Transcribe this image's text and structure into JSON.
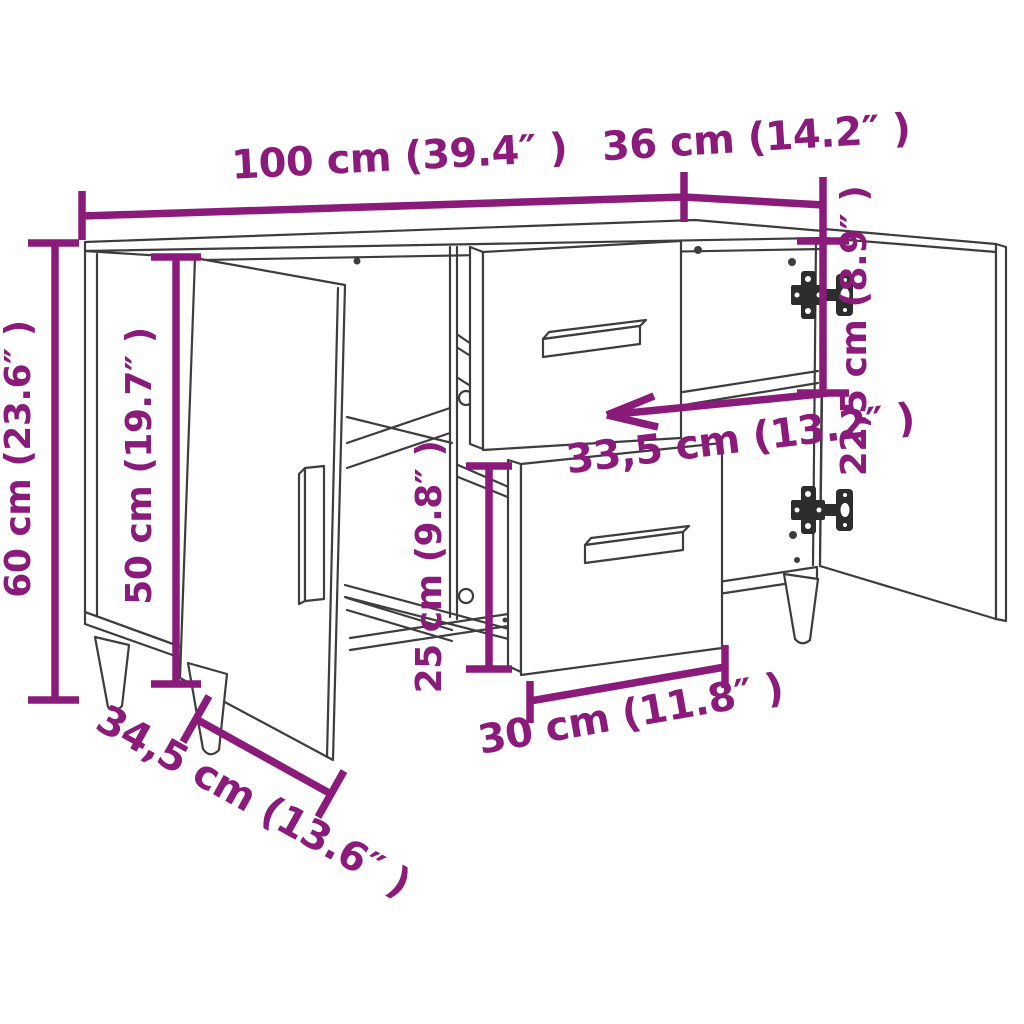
{
  "diagram": {
    "title": "Sideboard dimension diagram",
    "accent_color": "#8a1b7a",
    "line_color": "#3d3d3d",
    "background": "#ffffff",
    "dimensions": [
      {
        "id": "overall-width",
        "label": "100 cm (39.4″ )",
        "cm": 100,
        "inches": 39.4
      },
      {
        "id": "overall-depth",
        "label": "36 cm (14.2″ )",
        "cm": 36,
        "inches": 14.2
      },
      {
        "id": "overall-height",
        "label": "60 cm (23.6″ )",
        "cm": 60,
        "inches": 23.6
      },
      {
        "id": "door-height",
        "label": "50 cm (19.7″ )",
        "cm": 50,
        "inches": 19.7
      },
      {
        "id": "right-compartment-height",
        "label": "22,5 cm (8.9″ )",
        "cm": 22.5,
        "inches": 8.9
      },
      {
        "id": "compartment-width",
        "label": "33,5 cm (13.2″ )",
        "cm": 33.5,
        "inches": 13.2
      },
      {
        "id": "drawer-compartment-height",
        "label": "25 cm (9.8″ )",
        "cm": 25,
        "inches": 9.8
      },
      {
        "id": "drawer-width",
        "label": "30 cm (11.8″ )",
        "cm": 30,
        "inches": 11.8
      },
      {
        "id": "door-diagonal-width",
        "label": "34,5 cm (13.6″ )",
        "cm": 34.5,
        "inches": 13.6
      }
    ]
  }
}
